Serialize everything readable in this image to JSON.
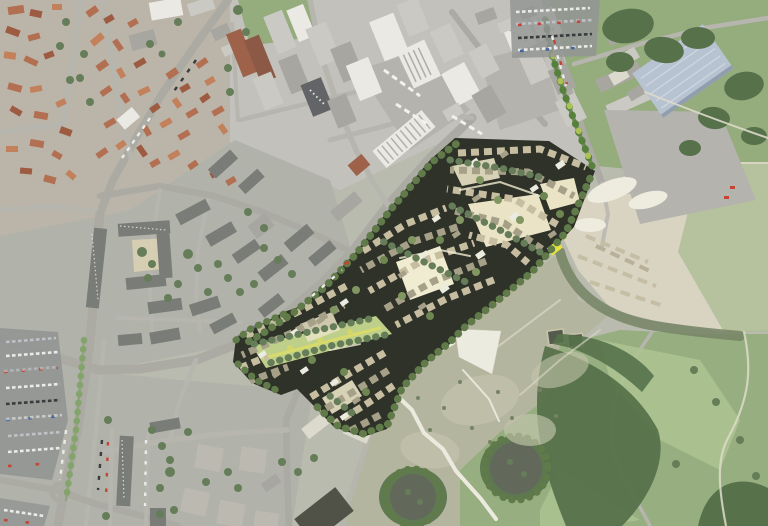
{
  "canvas": {
    "width": 768,
    "height": 526
  },
  "description": "Aerial photograph of a town: historic centre with red tiled roofs at top left, an industrial estate with large warehouses at top centre, a blue-roofed warehouse and sand quarry at right, wooded parkland and golf clearings at bottom right, boulevards and parking lots at bottom left. A rendered masterplan overlay of a new housing quarter — dense small blocks, courtyards, tree rows and a green corridor — runs diagonally across the centre.",
  "regions": {
    "old_town": "historic town centre with red tiled roofs and avenues",
    "industrial": "industrial estate with large warehouse halls and truck yards",
    "blue_warehouse": "large blue-roofed warehouse on tarmac apron",
    "residential": "mid-rise residential blocks around green courtyards",
    "bottom_left": "boulevard district with apartment slabs and street parking",
    "parking": "surface parking lot filled with cars",
    "masterplan": "rendered masterplan overlay of new housing quarter with courtyard blocks, tree rows and yellow accent building",
    "green_corridor": "linear green corridor through the masterplan",
    "quarry": "sand quarry with stockpile rows and settling basins",
    "scrub": "fallow scrub meadow crossed by new white footpaths",
    "footpaths": "white footpath network with triangular plaza",
    "parkland": "wooded parkland and golf fairways with circular clearings",
    "fields": "meadows and woods at top right",
    "roads": "road network",
    "vehicles": "parked cars and trucks"
  },
  "palette": {
    "base": "#b6b8ac",
    "urban-warm": "#b8b2a6",
    "indu-base": "#c0bfb9",
    "resid-base": "#aeafa7",
    "field-green": "#90a878",
    "field-light": "#a5b98e",
    "woods": "#4e6a42",
    "park-green": "#92ab7b",
    "fairway": "#a9c28e",
    "scrub": "#b1b29b",
    "scrub-light": "#c2c1a9",
    "shrub": "#6e7d5d",
    "quarry": "#d8d2c0",
    "quarry-light": "#eeebe0",
    "stockpile": "#c3bba2",
    "basin": "#4a5243",
    "clearing": "#5b6152",
    "road": "#a7a6a0",
    "road-minor": "#b3b2ac",
    "tarmac": "#b1b0aa",
    "dark-tarmac": "#8e9090",
    "median": "#7fa066",
    "tree-dark": "#5e7651",
    "tree-row": "#587440",
    "tree-bright": "#4e7a33",
    "tree-accent": "#a9c04d",
    "plan-dark": "#24271d",
    "plan-bldg": "#c5bb9f",
    "plan-bldg-dk": "#a39c84",
    "plan-white": "#ecebe1",
    "plan-court": "#eae3c5",
    "plan-court-2": "#f0ecd2",
    "plan-green": "#bcce84",
    "plan-stripe": "#d9da60",
    "plan-tree-1": "#7b9159",
    "plan-tree-2": "#66814a",
    "accent-yellow": "#e5e233",
    "roof-red": "#b0684a",
    "roof-red-dark": "#985238",
    "roof-orange": "#c07b53",
    "white-bldg": "#eae9e4",
    "light-gray": "#c8c7c2",
    "mid-gray": "#a3a29d",
    "dark-gray": "#5a5c60",
    "brick": "#9a5a42",
    "brick-dark": "#85503c",
    "block-gray": "#737571",
    "block-light": "#b8b6ae",
    "cream-bldg": "#dbd8cc",
    "dark-shed": "#47493f",
    "blue-roof": "#b5c1d2",
    "blue-ridge": "#cdd6e2",
    "court-sand": "#d9cfb2",
    "path-white": "#eceadf",
    "path-faint": "#dcd9c8",
    "car-white": "#ebebe9",
    "car-red": "#c23a2c",
    "car-blue": "#3c5c9a",
    "car-dark": "#2f3033",
    "car-silver": "#bcbfc4",
    "truck-white": "#f2f2ef"
  }
}
